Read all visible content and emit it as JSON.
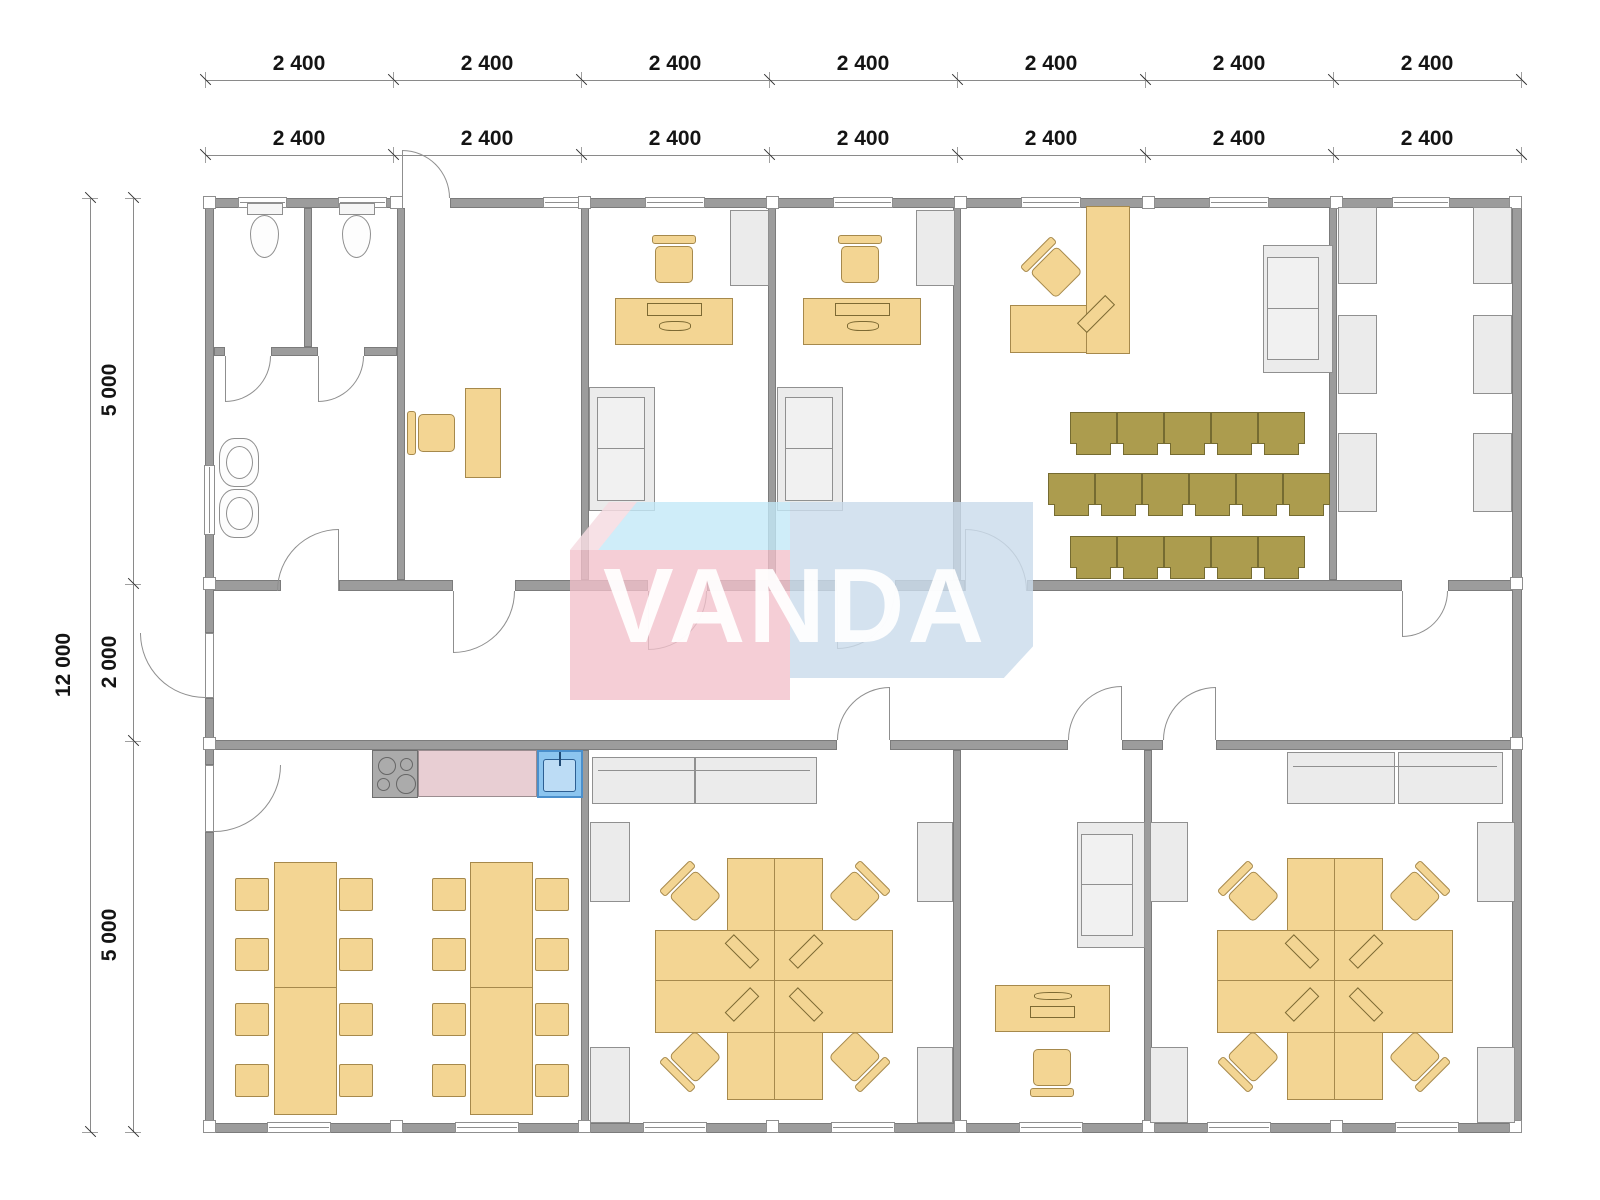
{
  "watermark": {
    "text": "VANDA"
  },
  "dims": {
    "top_outer": [
      "2 400",
      "2 400",
      "2 400",
      "2 400",
      "2 400",
      "2 400",
      "2 400"
    ],
    "top_inner": [
      "2 400",
      "2 400",
      "2 400",
      "2 400",
      "2 400",
      "2 400",
      "2 400"
    ],
    "left_total": "12 000",
    "left_segments": [
      "5 000",
      "2 000",
      "5 000"
    ]
  },
  "colors": {
    "wall": "#9c9c9c",
    "furniture": "#F3D593",
    "furniture_border": "#A6894C",
    "chair_olive": "#AC9C4E",
    "gray_furniture": "#EBEBEB",
    "counter_pink": "#E8CED3",
    "sink_blue": "#8CC5EF",
    "watermark_pink": "#F2C0CA",
    "watermark_light_pink": "#F6DCE2",
    "watermark_blue": "#CBDCEC",
    "watermark_cyan": "#C3E9F7"
  }
}
